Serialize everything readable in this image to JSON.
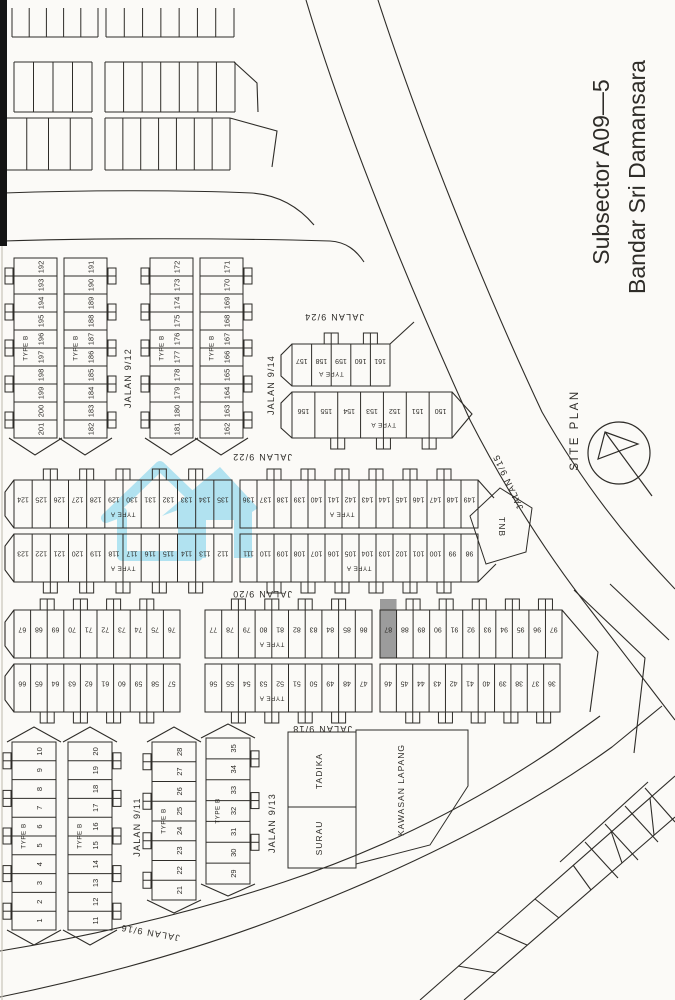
{
  "title": {
    "line1": "Subsector A09—5",
    "line2": "Bandar Sri Damansara"
  },
  "site_plan_label": "SITE PLAN",
  "watermark": {
    "color": "#8fd8ee"
  },
  "highlight": {
    "lot": "87",
    "fill": "#9c9c9c"
  },
  "map": {
    "ink": "#2e2c28",
    "paper": "#fbfaf7",
    "streets": [
      {
        "label": "JALAN 9/12",
        "x": 128,
        "y": 378,
        "rot": -90
      },
      {
        "label": "JALAN 9/14",
        "x": 271,
        "y": 385,
        "rot": -90
      },
      {
        "label": "JALAN 9/24",
        "x": 334,
        "y": 317,
        "rot": 180
      },
      {
        "label": "JALAN 9/22",
        "x": 262,
        "y": 457,
        "rot": 180
      },
      {
        "label": "JALAN 9/20",
        "x": 262,
        "y": 594,
        "rot": 180
      },
      {
        "label": "JALAN 9/18",
        "x": 322,
        "y": 729,
        "rot": 180
      },
      {
        "label": "JALAN 9/15",
        "x": 508,
        "y": 482,
        "rot": 245
      },
      {
        "label": "JALAN 9/11",
        "x": 137,
        "y": 827,
        "rot": -90
      },
      {
        "label": "JALAN 9/13",
        "x": 272,
        "y": 823,
        "rot": -90
      },
      {
        "label": "JALAN 9/16",
        "x": 150,
        "y": 933,
        "rot": 190
      }
    ],
    "areas": [
      {
        "label": "TNB",
        "poly": "470,516 500,488 532,508 526,552 486,564",
        "lx": 502,
        "ly": 527,
        "rot": 90
      },
      {
        "label": "TADIKA",
        "rect": [
          288,
          732,
          68,
          75
        ],
        "lx": 319,
        "ly": 771,
        "rot": -90
      },
      {
        "label": "SURAU",
        "rect": [
          288,
          807,
          68,
          61
        ],
        "lx": 319,
        "ly": 838,
        "rot": -90
      },
      {
        "label": "KAWASAN LAPANG",
        "poly": "356,730 468,730 468,786 430,845 356,864",
        "lx": 401,
        "ly": 790,
        "rot": -90
      }
    ],
    "vstrips": [
      {
        "x": 14,
        "w": 43,
        "y0": 258,
        "y1": 438,
        "lots": [
          "192",
          "193",
          "194",
          "195",
          "196",
          "197",
          "198",
          "199",
          "200",
          "201"
        ],
        "type": "TYPE B",
        "porch": "left"
      },
      {
        "x": 64,
        "w": 43,
        "y0": 258,
        "y1": 438,
        "lots": [
          "191",
          "190",
          "189",
          "188",
          "187",
          "186",
          "185",
          "184",
          "183",
          "182"
        ],
        "type": "TYPE B",
        "porch": "right"
      },
      {
        "x": 150,
        "w": 43,
        "y0": 258,
        "y1": 438,
        "lots": [
          "172",
          "173",
          "174",
          "175",
          "176",
          "177",
          "178",
          "179",
          "180",
          "181"
        ],
        "type": "TYPE B",
        "porch": "left"
      },
      {
        "x": 200,
        "w": 43,
        "y0": 258,
        "y1": 438,
        "lots": [
          "171",
          "170",
          "169",
          "168",
          "167",
          "166",
          "165",
          "164",
          "163",
          "162"
        ],
        "type": "TYPE B",
        "porch": "right"
      },
      {
        "x": 12,
        "w": 44,
        "y0": 742,
        "y1": 930,
        "lots": [
          "10",
          "9",
          "8",
          "7",
          "6",
          "5",
          "4",
          "3",
          "2",
          "1"
        ],
        "type": "TYPE B",
        "porch": "left"
      },
      {
        "x": 68,
        "w": 44,
        "y0": 742,
        "y1": 930,
        "lots": [
          "20",
          "19",
          "18",
          "17",
          "16",
          "15",
          "14",
          "13",
          "12",
          "11"
        ],
        "type": "TYPE B",
        "porch": "right"
      },
      {
        "x": 152,
        "w": 44,
        "y0": 742,
        "y1": 900,
        "lots": [
          "28",
          "27",
          "26",
          "25",
          "24",
          "23",
          "22",
          "21"
        ],
        "type": "TYPE B",
        "porch": "left"
      },
      {
        "x": 206,
        "w": 44,
        "y0": 738,
        "y1": 884,
        "lots": [
          "35",
          "34",
          "33",
          "32",
          "31",
          "30",
          "29"
        ],
        "type": "TYPE B",
        "porch": "right"
      }
    ],
    "hbands": [
      {
        "x0": 292,
        "x1": 390,
        "y0": 344,
        "y1": 386,
        "lots": [
          "157",
          "158",
          "159",
          "160",
          "161"
        ],
        "type": "TYPE A",
        "typeIdx": 2,
        "porch": "top"
      },
      {
        "x0": 292,
        "x1": 452,
        "y0": 392,
        "y1": 438,
        "lots": [
          "156",
          "155",
          "154",
          "153",
          "152",
          "151",
          "150"
        ],
        "type": "TYPE A",
        "typeIdx": 4,
        "porch": "bottom"
      },
      {
        "x0": 14,
        "x1": 232,
        "y0": 480,
        "y1": 528,
        "lots": [
          "124",
          "125",
          "126",
          "127",
          "128",
          "129",
          "130",
          "131",
          "132",
          "133",
          "134",
          "135"
        ],
        "type": "TYPE A",
        "typeIdx": 6,
        "porch": "top"
      },
      {
        "x0": 240,
        "x1": 478,
        "y0": 480,
        "y1": 528,
        "lots": [
          "136",
          "137",
          "138",
          "139",
          "140",
          "141",
          "142",
          "143",
          "144",
          "145",
          "146",
          "147",
          "148",
          "149"
        ],
        "type": "TYPE A",
        "typeIdx": 6,
        "porch": "top"
      },
      {
        "x0": 14,
        "x1": 232,
        "y0": 534,
        "y1": 582,
        "lots": [
          "123",
          "122",
          "121",
          "120",
          "119",
          "118",
          "117",
          "116",
          "115",
          "114",
          "113",
          "112"
        ],
        "type": "TYPE A",
        "typeIdx": 6,
        "porch": "bottom"
      },
      {
        "x0": 240,
        "x1": 478,
        "y0": 534,
        "y1": 582,
        "lots": [
          "111",
          "110",
          "109",
          "108",
          "107",
          "106",
          "105",
          "104",
          "103",
          "102",
          "101",
          "100",
          "99",
          "98"
        ],
        "type": "TYPE A",
        "typeIdx": 7,
        "porch": "bottom"
      },
      {
        "x0": 14,
        "x1": 180,
        "y0": 610,
        "y1": 658,
        "lots": [
          "67",
          "68",
          "69",
          "70",
          "71",
          "72",
          "73",
          "74",
          "75",
          "76"
        ],
        "porch": "top"
      },
      {
        "x0": 205,
        "x1": 372,
        "y0": 610,
        "y1": 658,
        "lots": [
          "77",
          "78",
          "79",
          "80",
          "81",
          "82",
          "83",
          "84",
          "85",
          "86"
        ],
        "type": "TYPE A",
        "typeIdx": 4,
        "porch": "top"
      },
      {
        "x0": 380,
        "x1": 562,
        "y0": 610,
        "y1": 658,
        "lots": [
          "87",
          "88",
          "89",
          "90",
          "91",
          "92",
          "93",
          "94",
          "95",
          "96",
          "97"
        ],
        "porch": "top"
      },
      {
        "x0": 14,
        "x1": 180,
        "y0": 664,
        "y1": 712,
        "lots": [
          "66",
          "65",
          "64",
          "63",
          "62",
          "61",
          "60",
          "59",
          "58",
          "57"
        ],
        "porch": "bottom"
      },
      {
        "x0": 205,
        "x1": 372,
        "y0": 664,
        "y1": 712,
        "lots": [
          "56",
          "55",
          "54",
          "53",
          "52",
          "51",
          "50",
          "49",
          "48",
          "47"
        ],
        "type": "TYPE A",
        "typeIdx": 4,
        "porch": "bottom"
      },
      {
        "x0": 380,
        "x1": 560,
        "y0": 664,
        "y1": 712,
        "lots": [
          "46",
          "45",
          "44",
          "43",
          "42",
          "41",
          "40",
          "39",
          "38",
          "37",
          "36"
        ],
        "porch": "bottom"
      }
    ],
    "combs": [
      {
        "y0": 8,
        "y1": 37,
        "openTop": true,
        "segs": [
          [
            12,
            98,
            6
          ],
          [
            106,
            234,
            8
          ]
        ]
      },
      {
        "y0": 62,
        "y1": 112,
        "openTop": false,
        "segs": [
          [
            14,
            92,
            5
          ],
          [
            105,
            235,
            8
          ]
        ]
      },
      {
        "y0": 118,
        "y1": 170,
        "openTop": false,
        "segs": [
          [
            5,
            92,
            5
          ],
          [
            105,
            230,
            8
          ]
        ]
      }
    ],
    "decor": [
      "M4,193 C90,190 185,190 252,193 C278,195 298,206 314,225",
      "M4,241 C100,238 225,238 330,241 C346,242 356,250 364,262",
      "M234,62 L257,83 L258,112",
      "M230,118 L277,131 L272,167",
      "M306,0 C344,128 410,288 470,420 C505,488 545,552 592,612 L675,720",
      "M378,0 C419,126 482,284 542,412 C575,470 614,524 661,574 L675,589",
      "M0,951 C92,936 190,913 284,882 C378,851 468,807 554,749 L600,716",
      "M0,997 C102,976 212,946 312,905 C422,861 526,809 612,747 L662,706",
      "M420,1000 L675,776",
      "M464,1000 L675,817",
      "M458,966 L496,973",
      "M497,932 L527,945",
      "M535,899 L559,918",
      "M573,865 L591,890",
      "M611,831 L622,863",
      "M650,798 L654,835",
      "M560,862 L648,782",
      "M585,842 L618,878",
      "M605,824 L638,860",
      "M625,806 L658,842",
      "M645,788 L675,822",
      "M574,590 L645,658 L634,753",
      "M610,584 L669,640",
      "M562,610 L598,652 L590,712",
      "M14,480 L5,492 L5,516 L14,528",
      "M14,534 L5,546 L5,570 L14,582",
      "M14,610 L5,622 L5,646 L14,658",
      "M14,664 L5,676 L5,700 L14,712",
      "M9,438 L35,455 L62,438",
      "M59,438 L85,455 L112,438",
      "M145,438 L171,455 L198,438",
      "M195,438 L221,455 L248,438",
      "M7,742 L34,727 L61,742",
      "M63,742 L90,727 L117,742",
      "M147,742 L174,727 L201,742",
      "M201,738 L228,724 L255,738",
      "M7,930 L34,945 L61,930",
      "M63,930 L90,945 L117,930",
      "M147,900 L174,913 L201,900",
      "M201,884 L228,896 L255,884",
      "M390,344 L414,322",
      "M452,392 L472,414 L452,438",
      "M292,344 L281,355 L281,376 L292,386",
      "M292,392 L281,403 L281,428 L292,438",
      "M478,480 L494,498",
      "M478,582 L496,564"
    ]
  }
}
